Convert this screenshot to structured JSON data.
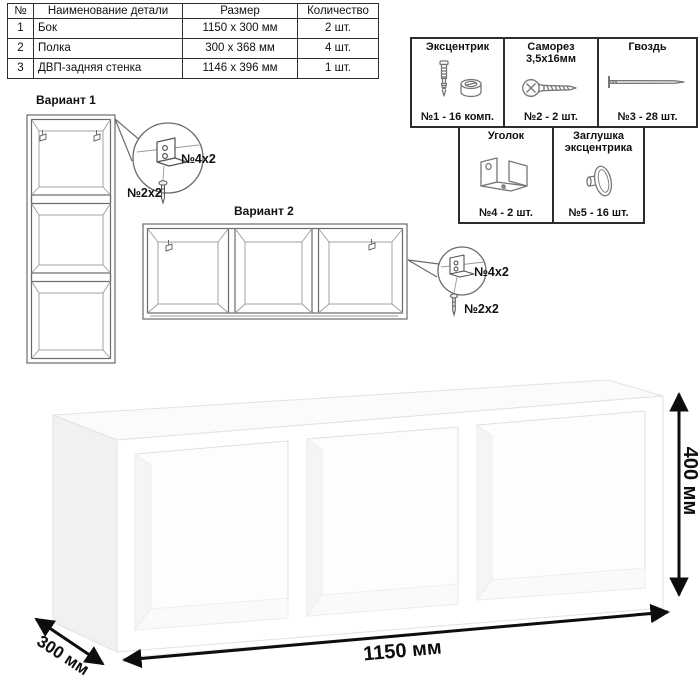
{
  "parts_table": {
    "headers": {
      "num": "№",
      "name": "Наименование детали",
      "size": "Размер",
      "qty": "Количество"
    },
    "rows": [
      {
        "num": "1",
        "name": "Бок",
        "size": "1150 х 300 мм",
        "qty": "2 шт."
      },
      {
        "num": "2",
        "name": "Полка",
        "size": "300 х 368 мм",
        "qty": "4 шт."
      },
      {
        "num": "3",
        "name": "ДВП-задняя стенка",
        "size": "1146 х 396 мм",
        "qty": "1 шт."
      }
    ]
  },
  "hardware": {
    "items": [
      {
        "title": "Эксцентрик",
        "count": "№1 - 16 комп.",
        "icon": "cam-dowel-icon"
      },
      {
        "title": "Саморез 3,5х16мм",
        "count": "№2 - 2 шт.",
        "icon": "screw-icon"
      },
      {
        "title": "Гвоздь",
        "count": "№3 - 28 шт.",
        "icon": "nail-icon"
      },
      {
        "title": "Уголок",
        "count": "№4 - 2 шт.",
        "icon": "angle-bracket-icon"
      },
      {
        "title": "Заглушка эксцентрика",
        "count": "№5 - 16 шт.",
        "icon": "cam-cap-icon"
      }
    ]
  },
  "variant1": {
    "title": "Вариант 1",
    "bracket_label": "№4х2",
    "screw_label": "№2х2"
  },
  "variant2": {
    "title": "Вариант 2",
    "bracket_label": "№4х2",
    "screw_label": "№2х2"
  },
  "model": {
    "width_label": "1150 мм",
    "height_label": "400 мм",
    "depth_label": "300 мм"
  },
  "colors": {
    "drawing_line": "#6b6b6b",
    "border": "#2d2d2d",
    "dim_text": "#0d0d0d",
    "side_shade": "#f1f1f1"
  }
}
